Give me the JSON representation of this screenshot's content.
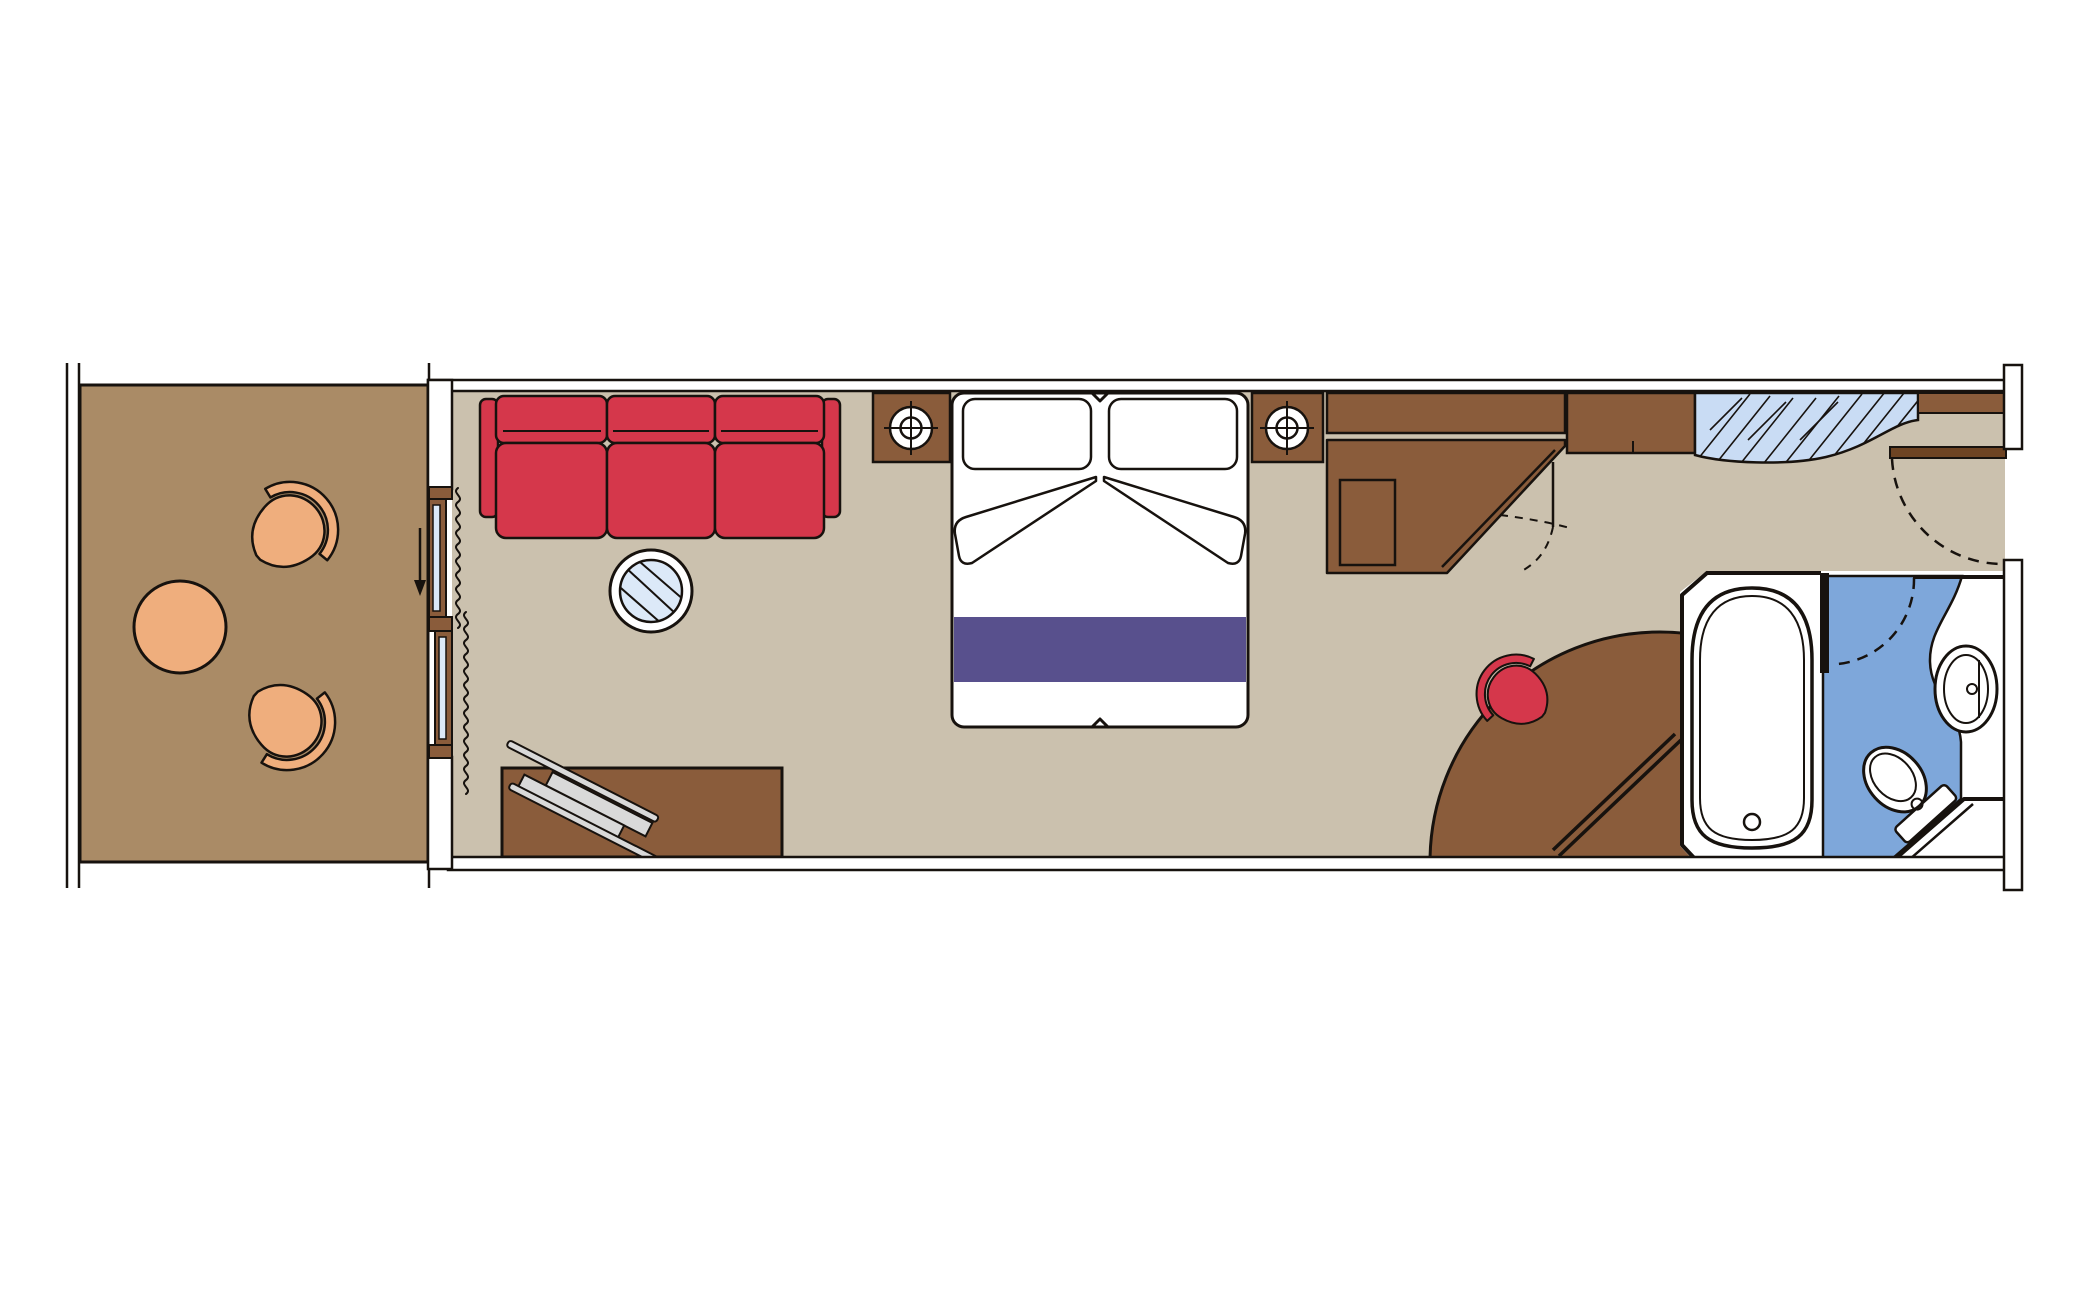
{
  "colors": {
    "background": "#ffffff",
    "line_black": "#17120e",
    "wall_white": "#ffffff",
    "floor_balcony": "#aa8b66",
    "floor_cabin": "#cbc1ae",
    "furniture_tan": "#efae7d",
    "furniture_brown": "#8a5c3b",
    "furniture_dark": "#6e4423",
    "accent_red": "#d5374b",
    "accent_purple": "#58508d",
    "glass_blue": "#dce9f8",
    "mirror_blue": "#c9dcf4",
    "bathroom_blue": "#7ea7da",
    "ski_gray": "#d9d9d9"
  },
  "rooms": {
    "balcony": {
      "label": "Balcony",
      "furniture": [
        "armchair",
        "armchair",
        "round-table",
        "sliding-door",
        "curtain"
      ]
    },
    "cabin": {
      "label": "Stateroom",
      "furniture": [
        "sofa",
        "glass-coffee-table",
        "luggage-bench",
        "nightstand",
        "lamp",
        "double-bed",
        "nightstand",
        "lamp",
        "wardrobe",
        "cabinet",
        "mirror-counter",
        "entry-door",
        "vanity-table",
        "desk-chair",
        "rail"
      ]
    },
    "bathroom": {
      "label": "Bathroom",
      "furniture": [
        "bathtub",
        "washbasin",
        "toilet",
        "door"
      ]
    }
  }
}
